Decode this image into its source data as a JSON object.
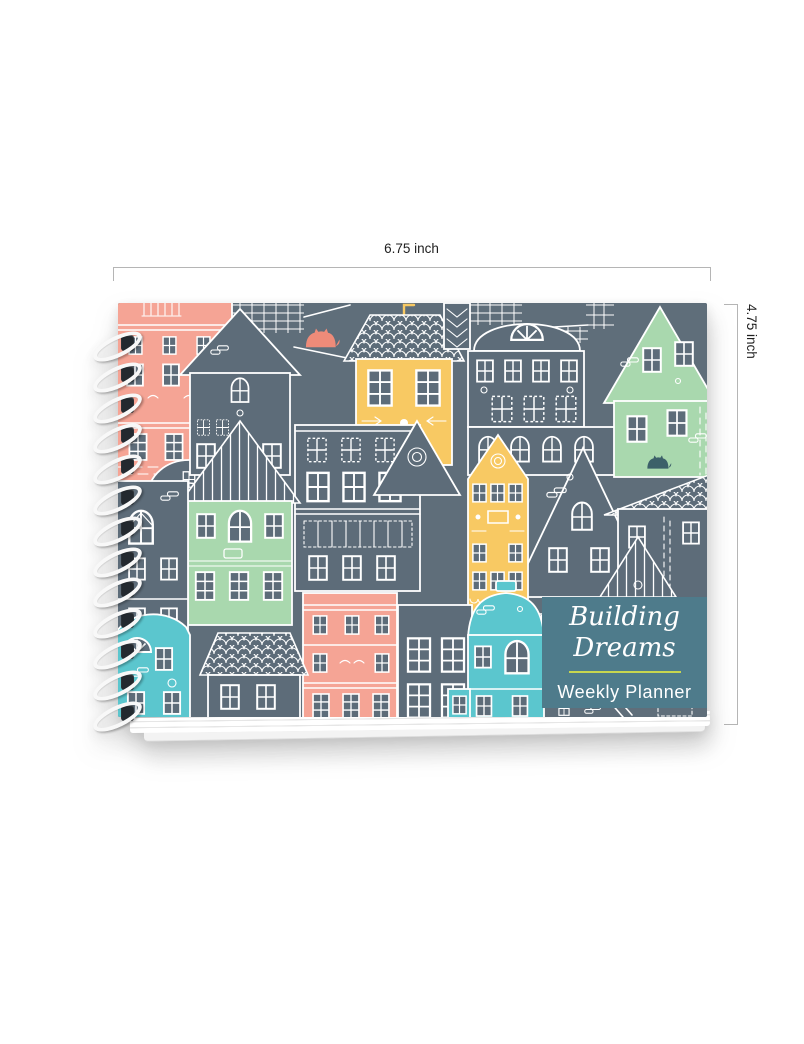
{
  "product_image": {
    "dimensions": {
      "width_label": "6.75 inch",
      "height_label": "4.75 inch"
    },
    "cover": {
      "title_line1": "Building",
      "title_line2": "Dreams",
      "subtitle": "Weekly Planner"
    },
    "colors": {
      "cover_background": "#5f6e7a",
      "house_slate": "#5d6c79",
      "house_salmon": "#f5a495",
      "house_yellow": "#f8c963",
      "house_mint": "#a9d8ae",
      "house_teal": "#5bc6ce",
      "accent_coral": "#ee8b79",
      "badge_background": "#4e7b8b",
      "badge_divider": "#c7d64f",
      "line_art": "#ffffff",
      "spiral_wire": "#f8f8f8",
      "spiral_hole": "#23292f",
      "dimension_line": "#b5b5b5",
      "dimension_text": "#1f1f1f"
    }
  }
}
